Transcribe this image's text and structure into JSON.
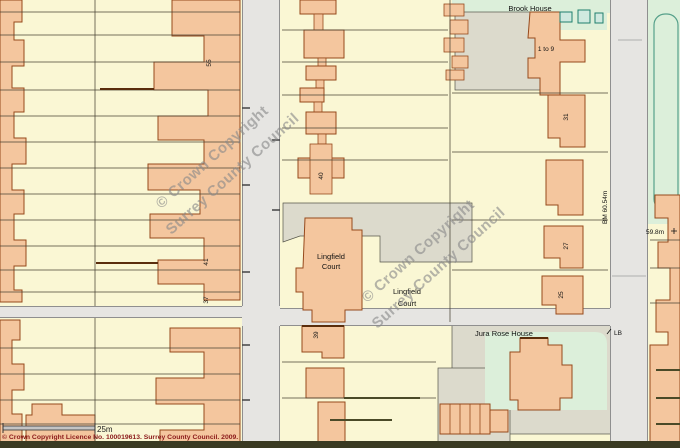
{
  "map": {
    "place_labels": {
      "brook_house": "Brook House",
      "flats_1_to_9": "1 to 9",
      "lingfield_court_line1": "Lingfield",
      "lingfield_court_line2": "Court",
      "jura_rose_house": "Jura Rose House"
    },
    "house_numbers": {
      "n55": "55",
      "n40": "40",
      "n41": "41",
      "n37": "37",
      "n39": "39",
      "n31": "31",
      "n27": "27",
      "n25": "25"
    },
    "annotations": {
      "letter_box": "LB",
      "spot_height": "59.8m",
      "bench_mark": "BM 60.54m"
    },
    "watermark": {
      "line1": "© Crown Copyright",
      "line2": "Surrey County Council"
    },
    "scale_bar": {
      "label": "25m"
    },
    "copyright_line": "© Crown Copyright Licence No. 100019613. Surrey County Council. 2009.",
    "colors": {
      "background": "#FAF7D4",
      "building_fill": "#F4C69E",
      "building_outline": "#96491C",
      "road_fill": "#E6E5E2",
      "road_casing": "#8F8F8F",
      "hard_surface": "#DCDACC",
      "green_space": "#DCEFDA",
      "green_outline": "#56A08A",
      "parcel_line": "#4A4436",
      "watermark_text": "#8A8A8A",
      "copyright_text": "#8B1A1A"
    }
  }
}
